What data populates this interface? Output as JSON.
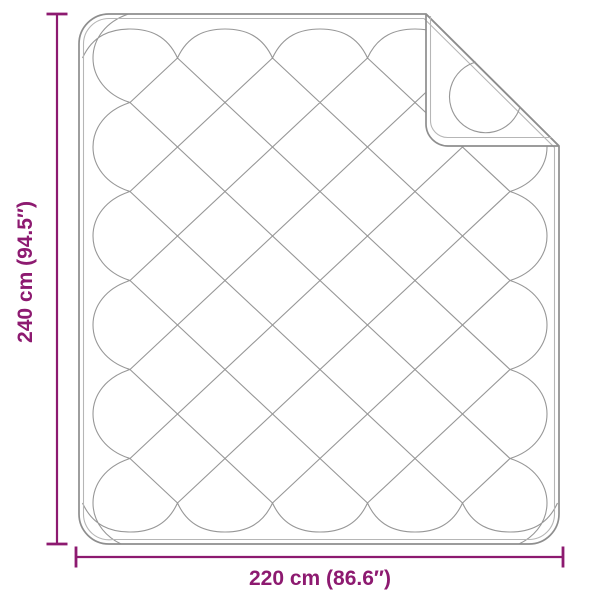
{
  "diagram": {
    "product": "quilted-blanket-with-folded-corner",
    "height_label": "240 cm (94.5″)",
    "width_label": "220 cm (86.6″)",
    "accent_color": "#8d1a70",
    "outline_color": "#8e8e8e",
    "outline_inner_color": "#b6b6b6",
    "pattern_color": "#979797",
    "background": "#ffffff"
  }
}
